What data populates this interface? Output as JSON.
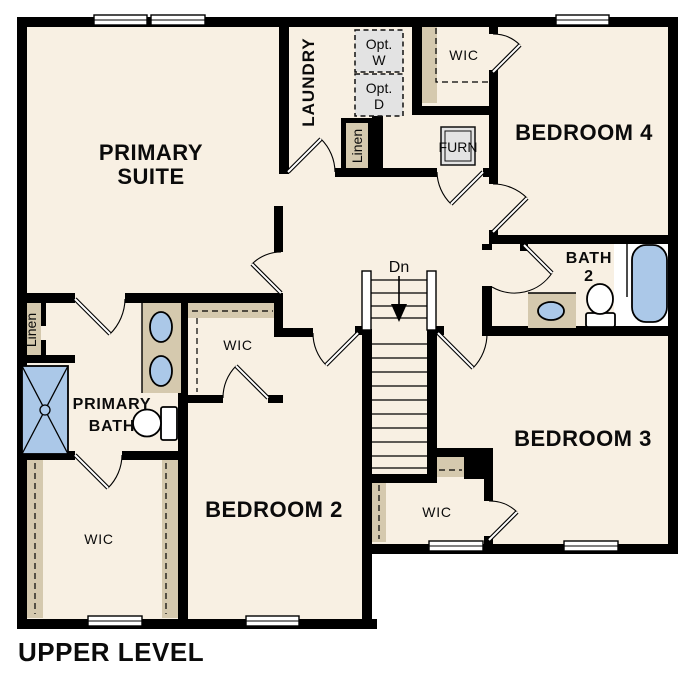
{
  "plan_title": "UPPER LEVEL",
  "level": {
    "name": "UPPER LEVEL"
  },
  "colors": {
    "wall": "#000000",
    "floor": "#f8f0e3",
    "closet_shelf": "#d5c9ae",
    "fixture_blue": "#abc8e8",
    "appliance_gray": "#e3e3e3",
    "background": "#ffffff"
  },
  "rooms": {
    "primary_suite": {
      "line1": "PRIMARY",
      "line2": "SUITE"
    },
    "laundry": {
      "label": "LAUNDRY"
    },
    "opt_washer": {
      "line1": "Opt.",
      "line2": "W"
    },
    "opt_dryer": {
      "line1": "Opt.",
      "line2": "D"
    },
    "wic_bedroom4": {
      "label": "WIC"
    },
    "furnace": {
      "label": "FURN"
    },
    "bedroom4": {
      "label": "BEDROOM 4"
    },
    "bath2": {
      "line1": "BATH",
      "line2": "2"
    },
    "linen_hall": {
      "label": "Linen"
    },
    "linen_primary": {
      "label": "Linen"
    },
    "stairs": {
      "label": "Dn"
    },
    "wic_bedroom2": {
      "label": "WIC"
    },
    "primary_bath": {
      "line1": "PRIMARY",
      "line2": "BATH"
    },
    "bedroom2": {
      "label": "BEDROOM 2"
    },
    "bedroom3": {
      "label": "BEDROOM 3"
    },
    "wic_bedroom3": {
      "label": "WIC"
    },
    "wic_primary": {
      "label": "WIC"
    }
  },
  "fixtures": {
    "shower": "shower-pan",
    "tub": "bathtub",
    "toilets": [
      "primary-bath-toilet",
      "bath2-toilet"
    ],
    "sinks": [
      "primary-vanity-sink-1",
      "primary-vanity-sink-2",
      "bath2-vanity-sink"
    ],
    "stairs_direction": "Dn"
  }
}
